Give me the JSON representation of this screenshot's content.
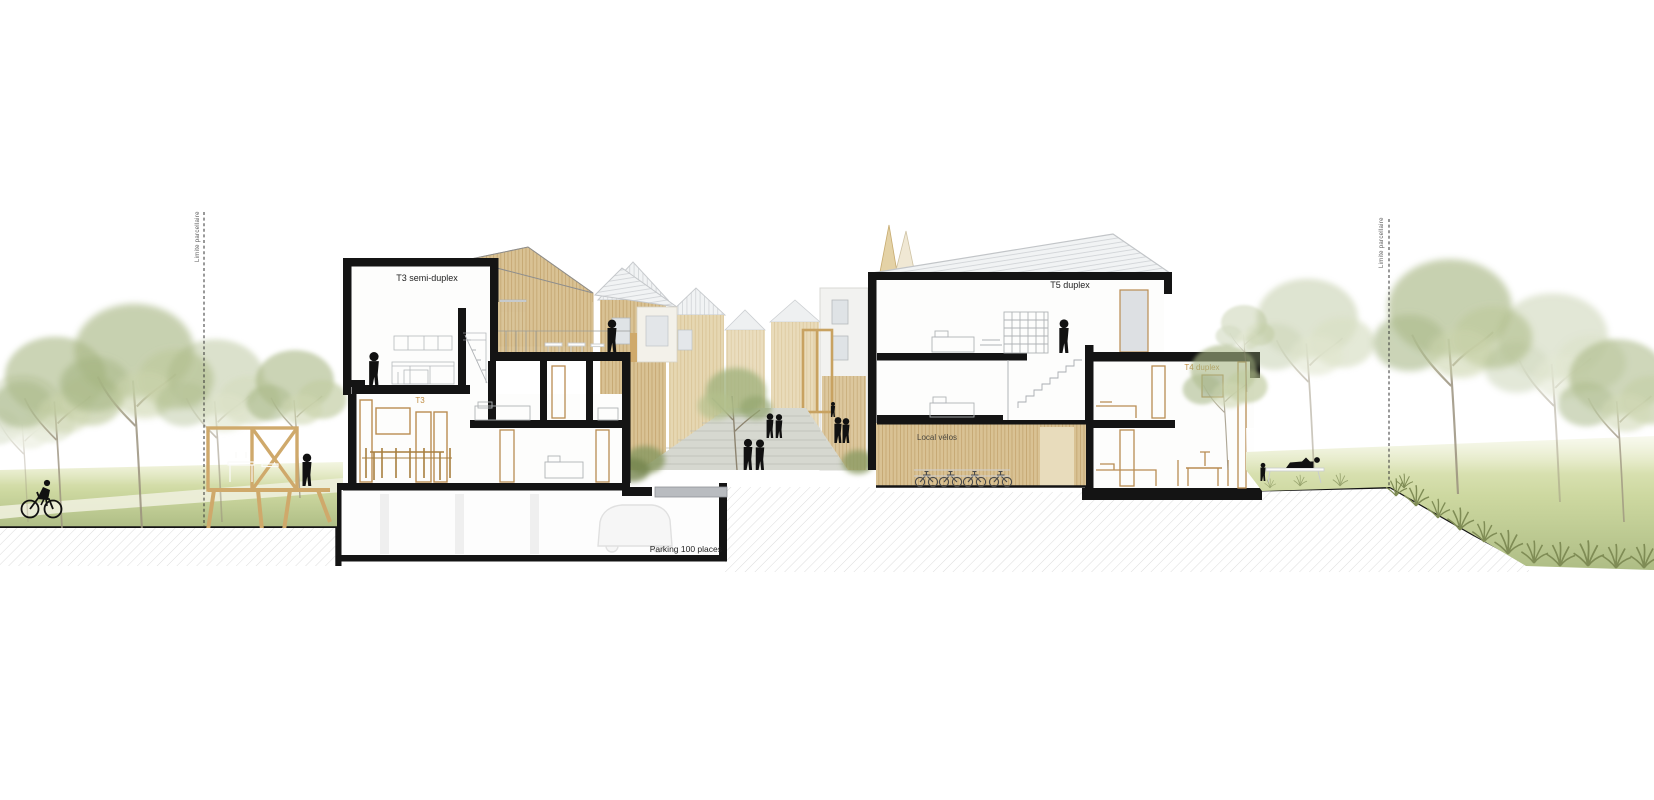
{
  "scene": {
    "type": "architectural-section-drawing",
    "labels": {
      "t3_semi_duplex": "T3 semi-duplex",
      "t3": "T3",
      "t5_duplex": "T5 duplex",
      "t4_duplex": "T4 duplex",
      "local_velos": "Local vélos",
      "parking": "Parking 100 places",
      "limite_left": "Limite parcellaire",
      "limite_right": "Limite parcellaire"
    },
    "colors": {
      "wall_black": "#141414",
      "wood_cladding": "#d9c294",
      "wood_frame": "#b98c52",
      "label_accent": "#bf8b3f",
      "roof_light": "#eff1f2",
      "grass_light": "#dfe5ba",
      "grass_dark": "#aebd85",
      "foliage_green": "#a8b784",
      "paving_gray": "#d6d8d0",
      "hatch_gray": "#dcdcdc"
    }
  }
}
